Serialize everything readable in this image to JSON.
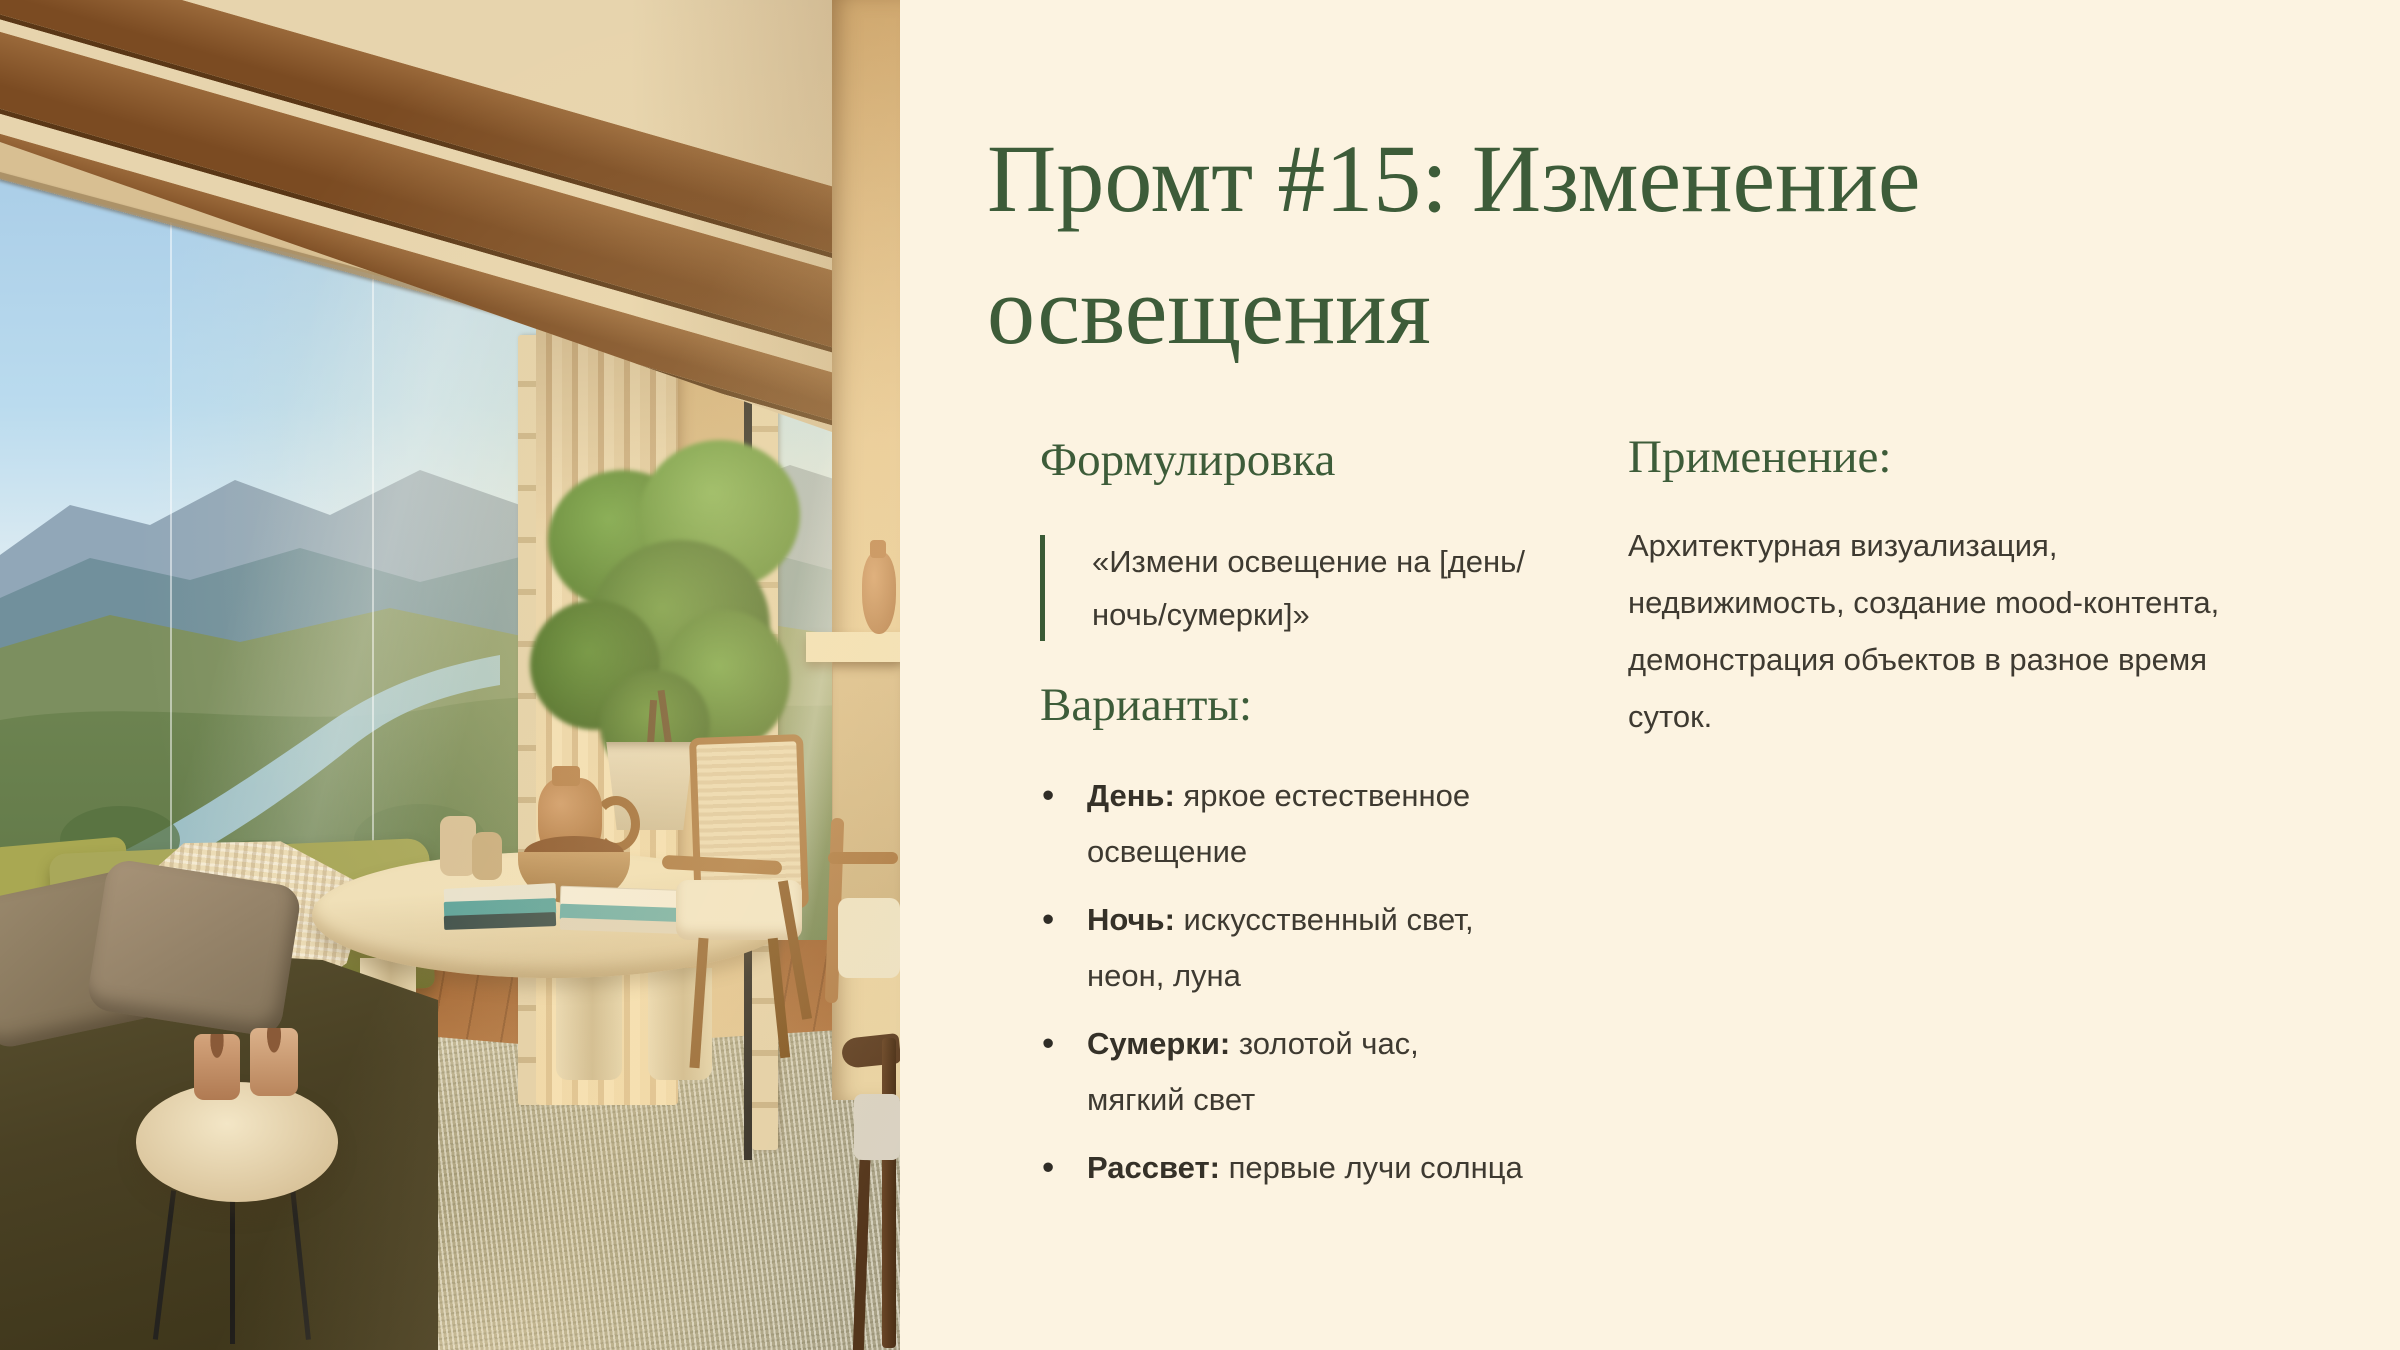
{
  "slide": {
    "background_color": "#fcf3e1",
    "accent_green": "#3d5c39",
    "body_text_color": "#3e3a31",
    "title": "Промт #15: Изменение освещения",
    "formulation": {
      "heading": "Формулировка",
      "quote_line1": "«Измени освещение на [день/",
      "quote_line2": "ночь/сумерки]»"
    },
    "variants": {
      "heading": "Варианты:",
      "bullet_char": "•",
      "items": [
        {
          "term": "День:",
          "text": " яркое естественное",
          "text_line2": "освещение"
        },
        {
          "term": "Ночь:",
          "text": " искусственный свет,",
          "text_line2": "неон, луна"
        },
        {
          "term": "Сумерки:",
          "text": " золотой час,",
          "text_line2": "мягкий свет"
        },
        {
          "term": "Рассвет:",
          "text": " первые лучи солнца",
          "text_line2": ""
        }
      ]
    },
    "application": {
      "heading": "Применение:",
      "body": "Архитектурная визуализация, недвижимость, создание mood-контента, демонстрация объектов в разное время суток."
    },
    "photo_palette": {
      "sky": "#a5c8e4",
      "mountains": "#7e97a8",
      "hills": "#7c8f5f",
      "river": "#a3c6d3",
      "curtain": "#e3cba0",
      "wood_beam": "#8a5a2e",
      "wall_tan": "#d9ba88",
      "sofa_olive": "#4a4124",
      "chaise_green": "#9a9a4c",
      "rug": "#ccc1a0"
    }
  }
}
